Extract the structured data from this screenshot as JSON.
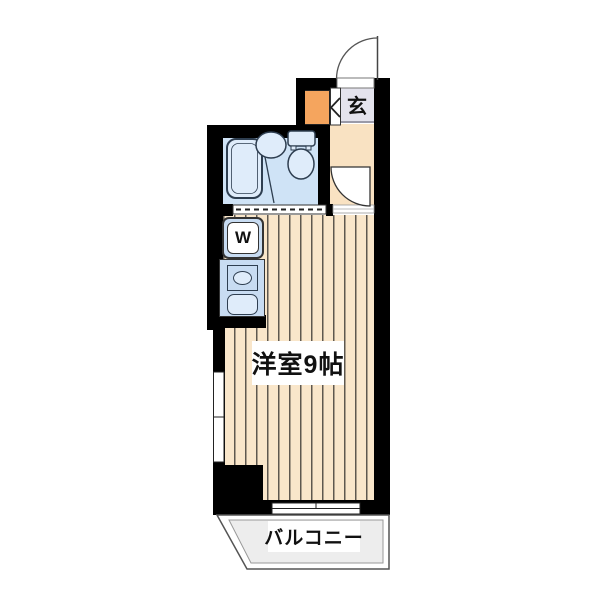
{
  "title": "apartment floor plan",
  "rooms": {
    "entrance": {
      "label": "玄"
    },
    "main_room": {
      "label": "洋室9帖"
    },
    "balcony": {
      "label": "バルコニー"
    },
    "washer": {
      "label": "W"
    }
  },
  "colors": {
    "wall": "#000000",
    "flooring_bg": "#f9e6ca",
    "flooring_stripe": "#5e584f",
    "bathroom_floor": "#cfe3f6",
    "fixture_fill": "#dfecfa",
    "fixture_outline": "#2e3e50",
    "genkan_floor": "#e4e3ed",
    "hallway_floor": "#f9e2c2",
    "shoe_cabinet": "#f5a55e",
    "kitchen_unit": "#c8dcf2",
    "balcony_floor": "#ededed"
  }
}
